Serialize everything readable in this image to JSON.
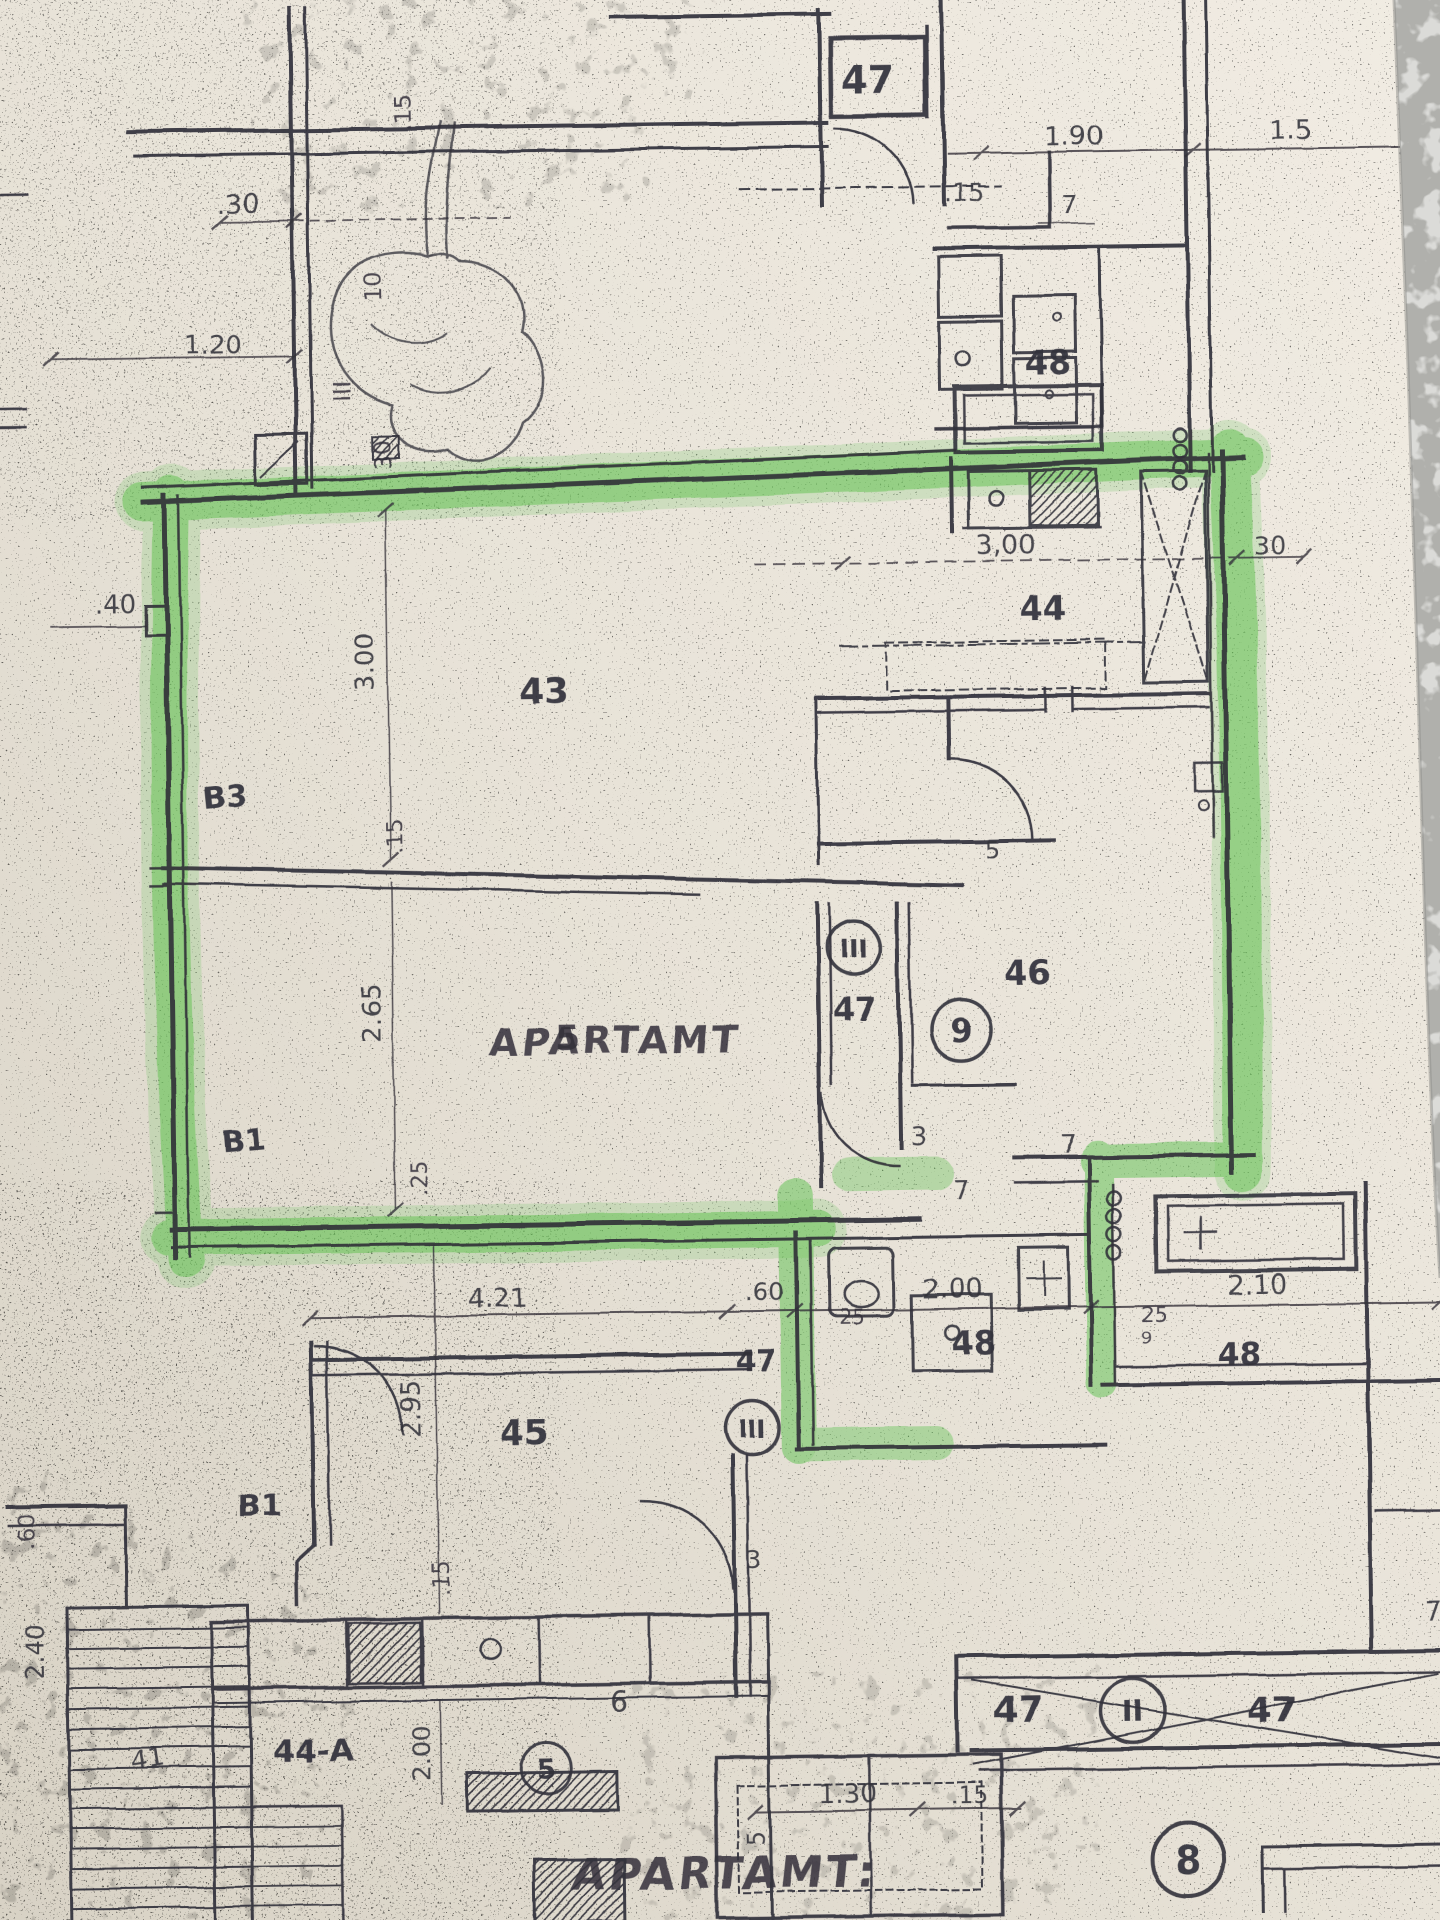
{
  "meta": {
    "paper_color": "#e9e4da",
    "ink_color": "#32313a",
    "highlight_color": "#5abf4b",
    "marble_color": "#b0b0ac"
  },
  "top": {
    "room47": "47",
    "dim15": ".15",
    "dim190": "1.90",
    "dim15r": "1.5",
    "dim7": "7",
    "room48": "48",
    "dim30": ".30",
    "dim120": "1.20",
    "dim15v": ".15",
    "dim10v": "10",
    "roman3v": "III",
    "dim30v": "30"
  },
  "apartment": {
    "dim40": ".40",
    "dim300v": "3.00",
    "room43": "43",
    "balcony_b3": "B3",
    "dim15v": ".15",
    "dim300k": "3,00",
    "room44": "44",
    "dim30r": "30",
    "dim265v": "2.65",
    "unit_number": "5",
    "unit_word": "APARTAMT",
    "hall47": "47",
    "hall_roman3": "III",
    "stamp9": "9",
    "room46": "46",
    "dim5": "5",
    "door3": "3",
    "dim7": "7",
    "dim7b": "7",
    "balcony_b1": "B1",
    "dim25v": ".25",
    "bath48": "48",
    "dim25": "25"
  },
  "chain": {
    "d421": "4.21",
    "d60": ".60",
    "d200": "2.00",
    "d210": "2.10",
    "d25": "25",
    "d9": "9",
    "room48": "48"
  },
  "lower": {
    "room45": "45",
    "dim295v": "2.95",
    "balcony_b1": "B1",
    "dim15v": ".15",
    "lobby47": "47",
    "lobby_roman3": "III",
    "door3": "3",
    "dim60v": ".60",
    "dim240v": "2.40",
    "room44a": "44-A",
    "dim200v": "2.00",
    "circle5": "5",
    "num41": "41",
    "dim6": "6",
    "dim5v": "5"
  },
  "corridor": {
    "left47": "47",
    "roman2": "II",
    "right47": "47",
    "dim130": "1.30",
    "dim15": ".15",
    "dim7": "7"
  },
  "footer": {
    "apt_label": "APARTAMT:",
    "apt_number": "8"
  }
}
